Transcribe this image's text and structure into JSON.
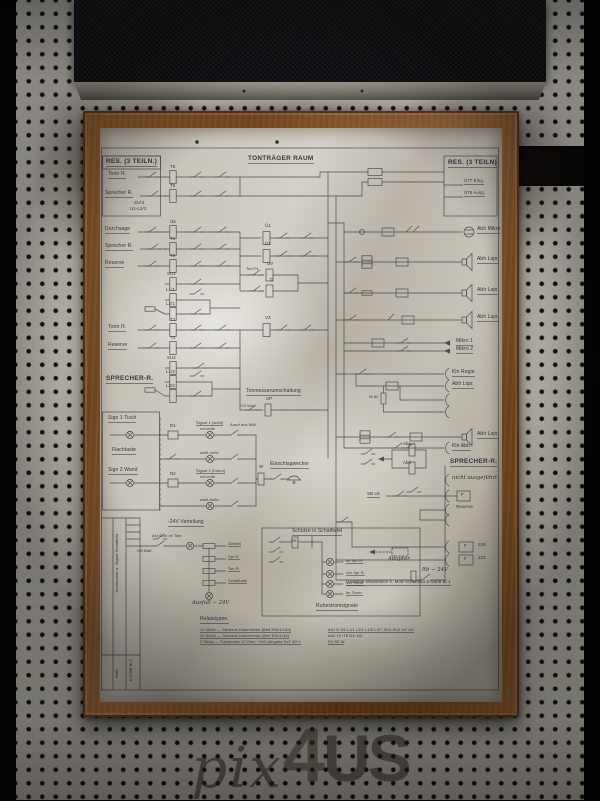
{
  "colors": {
    "wood_frame": "#7a4a22",
    "pegboard": "#c7c3bb",
    "paper": "#c5c0b5",
    "ink": "#34353d",
    "grille": "#0e1013"
  },
  "watermark": {
    "script": "pix",
    "digit": "4",
    "caps": "US"
  },
  "poster": {
    "title": "TONTRÄGER RAUM",
    "sheet_number": "D-5608 Bl 2",
    "labels": [
      {
        "t": "TONTRÄGER RAUM",
        "x": 148,
        "y": 28,
        "c": "hdr u"
      },
      {
        "t": "RES. (3 TEILN.)",
        "x": 6,
        "y": 31,
        "c": "hdr u"
      },
      {
        "t": "RES. (3 TEILN)",
        "x": 348,
        "y": 32,
        "c": "hdr u"
      },
      {
        "t": "SPRECHER-R.",
        "x": 6,
        "y": 248,
        "c": "hdr u"
      },
      {
        "t": "SPRECHER-R.",
        "x": 350,
        "y": 331,
        "c": "hdr u"
      },
      {
        "t": "Tontr R.",
        "x": 8,
        "y": 44,
        "c": "u"
      },
      {
        "t": "Sprecher R.",
        "x": 5,
        "y": 63,
        "c": "u"
      },
      {
        "t": "SU/3",
        "x": 34,
        "y": 73,
        "c": "sm"
      },
      {
        "t": "U1-L2/3",
        "x": 30,
        "y": 79,
        "c": "sm"
      },
      {
        "t": "Durchsage",
        "x": 5,
        "y": 99,
        "c": "u"
      },
      {
        "t": "Sprecher R.",
        "x": 5,
        "y": 116,
        "c": "u"
      },
      {
        "t": "Reserve",
        "x": 5,
        "y": 133,
        "c": "u"
      },
      {
        "t": "Tontr R.",
        "x": 8,
        "y": 197,
        "c": "u"
      },
      {
        "t": "Reserve",
        "x": 8,
        "y": 215,
        "c": "u"
      },
      {
        "t": "Sign 1 Tisch",
        "x": 8,
        "y": 288,
        "c": "u"
      },
      {
        "t": "Flachtaste",
        "x": 12,
        "y": 320,
        "c": "u"
      },
      {
        "t": "Sign 2 Wand",
        "x": 8,
        "y": 340,
        "c": "u"
      },
      {
        "t": "T5",
        "x": 70,
        "y": 37,
        "c": "sm"
      },
      {
        "t": "T6",
        "x": 70,
        "y": 56,
        "c": "sm"
      },
      {
        "t": "Ü5",
        "x": 70,
        "y": 92,
        "c": "sm"
      },
      {
        "t": "T1",
        "x": 70,
        "y": 109,
        "c": "sm"
      },
      {
        "t": "T2",
        "x": 70,
        "y": 126,
        "c": "sm"
      },
      {
        "t": "SU1",
        "x": 67,
        "y": 144,
        "c": "sm"
      },
      {
        "t": "L1/1",
        "x": 66,
        "y": 160,
        "c": "sm"
      },
      {
        "t": "L2/1",
        "x": 66,
        "y": 174,
        "c": "sm"
      },
      {
        "t": "T3",
        "x": 70,
        "y": 190,
        "c": "sm"
      },
      {
        "t": "T4",
        "x": 70,
        "y": 208,
        "c": "sm"
      },
      {
        "t": "SU2",
        "x": 67,
        "y": 228,
        "c": "sm"
      },
      {
        "t": "L1/2",
        "x": 66,
        "y": 242,
        "c": "sm"
      },
      {
        "t": "L2/2",
        "x": 66,
        "y": 256,
        "c": "sm"
      },
      {
        "t": "Ü1",
        "x": 165,
        "y": 96,
        "c": "sm"
      },
      {
        "t": "Ü2",
        "x": 165,
        "y": 114,
        "c": "sm"
      },
      {
        "t": "UV",
        "x": 167,
        "y": 134,
        "c": "sm"
      },
      {
        "t": "D",
        "x": 170,
        "y": 150,
        "c": "sm"
      },
      {
        "t": "Ton/T4",
        "x": 146,
        "y": 139,
        "c": "xs"
      },
      {
        "t": "V3",
        "x": 165,
        "y": 188,
        "c": "sm"
      },
      {
        "t": "UP",
        "x": 166,
        "y": 269,
        "c": "sm"
      },
      {
        "t": "+24 Von",
        "x": 139,
        "y": 276,
        "c": "xs"
      },
      {
        "t": "Ü77 Eing.",
        "x": 364,
        "y": 51,
        "c": "u sm"
      },
      {
        "t": "Ü76 Ausg.",
        "x": 364,
        "y": 63,
        "c": "u sm"
      },
      {
        "t": "Abh Mikro",
        "x": 377,
        "y": 99,
        "c": "u"
      },
      {
        "t": "Abh Lspr.",
        "x": 377,
        "y": 129,
        "c": "u"
      },
      {
        "t": "Abh Lspr.",
        "x": 377,
        "y": 160,
        "c": "u"
      },
      {
        "t": "Abh Lspr.",
        "x": 377,
        "y": 187,
        "c": "u"
      },
      {
        "t": "Mikro 1",
        "x": 356,
        "y": 211,
        "c": "u"
      },
      {
        "t": "Mikro 2",
        "x": 356,
        "y": 219,
        "c": "u"
      },
      {
        "t": "Kln Regie",
        "x": 352,
        "y": 242,
        "c": "u"
      },
      {
        "t": "Abh Lspr.",
        "x": 352,
        "y": 254,
        "c": "u"
      },
      {
        "t": "W 80",
        "x": 269,
        "y": 267,
        "c": "xs"
      },
      {
        "t": "Abh Lspr.",
        "x": 377,
        "y": 304,
        "c": "u"
      },
      {
        "t": "Kln Abh.",
        "x": 352,
        "y": 316,
        "c": "u"
      },
      {
        "t": "Ab1",
        "x": 303,
        "y": 314,
        "c": "sm"
      },
      {
        "t": "Ab2",
        "x": 303,
        "y": 333,
        "c": "sm"
      },
      {
        "t": "SB Uk",
        "x": 267,
        "y": 364,
        "c": "sm u"
      },
      {
        "t": "nicht ausgeführt",
        "x": 352,
        "y": 348,
        "c": "hw"
      },
      {
        "t": "F",
        "x": 361,
        "y": 365,
        "c": "sm"
      },
      {
        "t": "Reserve",
        "x": 356,
        "y": 377,
        "c": "sm"
      },
      {
        "t": "F",
        "x": 364,
        "y": 416,
        "c": "sm"
      },
      {
        "t": "238",
        "x": 378,
        "y": 415,
        "c": "sm"
      },
      {
        "t": "F",
        "x": 364,
        "y": 429,
        "c": "sm"
      },
      {
        "t": "233",
        "x": 378,
        "y": 428,
        "c": "sm"
      },
      {
        "t": "Adapter",
        "x": 288,
        "y": 429,
        "c": "hw"
      },
      {
        "t": "Rb − 24V",
        "x": 322,
        "y": 440,
        "c": "hw"
      },
      {
        "t": "Gesamte Modulation s. Mod-Schaltbild D-5608 Bl 1",
        "x": 246,
        "y": 452,
        "c": "u sm"
      },
      {
        "t": "Tonmesserumschaltung",
        "x": 146,
        "y": 261,
        "c": "u"
      },
      {
        "t": "Signal 1 (weiß)",
        "x": 96,
        "y": 293,
        "c": "u xs"
      },
      {
        "t": "rot-helle",
        "x": 100,
        "y": 299,
        "c": "xs"
      },
      {
        "t": "Anruf aus MW",
        "x": 130,
        "y": 295,
        "c": "xs"
      },
      {
        "t": "weiß-helle",
        "x": 100,
        "y": 323,
        "c": "xs"
      },
      {
        "t": "Signal 2 (braun)",
        "x": 96,
        "y": 341,
        "c": "u xs"
      },
      {
        "t": "rot-helle",
        "x": 100,
        "y": 347,
        "c": "xs"
      },
      {
        "t": "weiß-helle",
        "x": 100,
        "y": 370,
        "c": "xs"
      },
      {
        "t": "R1",
        "x": 70,
        "y": 296,
        "c": "sm"
      },
      {
        "t": "R2",
        "x": 70,
        "y": 344,
        "c": "sm"
      },
      {
        "t": "W",
        "x": 159,
        "y": 337,
        "c": "sm"
      },
      {
        "t": "Einschlagwecker",
        "x": 170,
        "y": 334,
        "c": "u"
      },
      {
        "t": "-24V Verteilung",
        "x": 68,
        "y": 392,
        "c": "u"
      },
      {
        "t": "Anl Schr im Takt",
        "x": 52,
        "y": 406,
        "c": "xs"
      },
      {
        "t": "+24 Batt",
        "x": 36,
        "y": 421,
        "c": "xs"
      },
      {
        "t": "Gestell",
        "x": 128,
        "y": 414,
        "c": "u xs"
      },
      {
        "t": "Spr R.",
        "x": 128,
        "y": 427,
        "c": "u xs"
      },
      {
        "t": "Ton R.",
        "x": 128,
        "y": 439,
        "c": "u xs"
      },
      {
        "t": "Schalttafel",
        "x": 128,
        "y": 451,
        "c": "u xs"
      },
      {
        "t": "Ausfall − 24V",
        "x": 92,
        "y": 473,
        "c": "hw"
      },
      {
        "t": "Schütze in Schalttafel",
        "x": 192,
        "y": 401,
        "c": "u"
      },
      {
        "t": "SR",
        "x": 191,
        "y": 411,
        "c": "xs"
      },
      {
        "t": "Im Spr R.",
        "x": 246,
        "y": 431,
        "c": "u xs"
      },
      {
        "t": "Vor Spr R.",
        "x": 246,
        "y": 443,
        "c": "u xs"
      },
      {
        "t": "Vor Tonm.",
        "x": 246,
        "y": 453,
        "c": "u xs"
      },
      {
        "t": "Im Tonm.",
        "x": 246,
        "y": 463,
        "c": "u xs"
      },
      {
        "t": "Ruhestromsignale",
        "x": 216,
        "y": 476,
        "c": "u"
      },
      {
        "t": "Relaistypen.",
        "x": 100,
        "y": 489,
        "c": "u"
      },
      {
        "t": "11 Stück — Siemens Kammrelais (Bed EN21/15a)",
        "x": 100,
        "y": 500,
        "c": "u xs"
      },
      {
        "t": "10 Stück — Siemens Kammrelais (Bed EN21/3a)",
        "x": 100,
        "y": 506,
        "c": "u xs"
      },
      {
        "t": "2 Stück — Flachrelais 12 Ohm −100 (Angabe ÜvT 50−)",
        "x": 100,
        "y": 512,
        "c": "u xs"
      },
      {
        "t": "Ab1 D D5 L1/1 L2/1 L1/2 L3/7 SU1 SU2 UP UV",
        "x": 228,
        "y": 500,
        "c": "u xs"
      },
      {
        "t": "Ab2 T1−T8 Ü1−Ü3",
        "x": 228,
        "y": 506,
        "c": "xs"
      },
      {
        "t": "R1 R2 W",
        "x": 228,
        "y": 512,
        "c": "u xs"
      },
      {
        "t": "Kommando u. Signal Schaltbild",
        "x": 15,
        "y": 406,
        "c": "v"
      },
      {
        "t": "D-5608 Bl 2",
        "x": 29,
        "y": 531,
        "c": "v"
      },
      {
        "t": "EMB",
        "x": 15,
        "y": 541,
        "c": "v"
      }
    ]
  }
}
